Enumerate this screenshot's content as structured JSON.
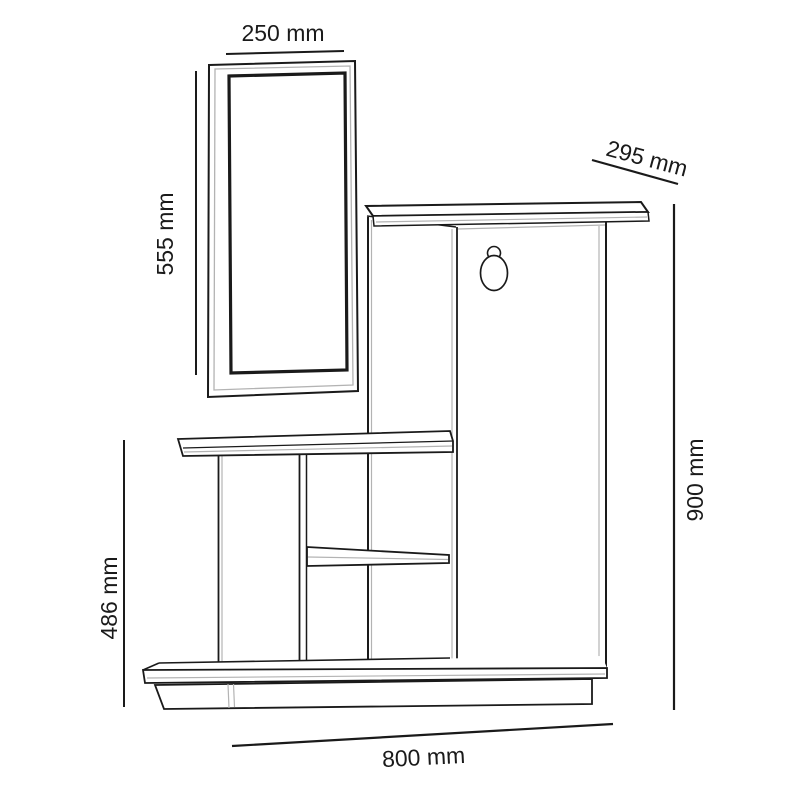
{
  "diagram": {
    "unit": "mm",
    "background": "#ffffff",
    "line_color": "#1a1a1a",
    "soft_line_color": "#b3b3b3"
  },
  "dimensions": {
    "mirror_width": "250 mm",
    "mirror_height": "555 mm",
    "top_depth": "295 mm",
    "total_height": "900 mm",
    "left_section_height": "486 mm",
    "total_width": "800 mm"
  }
}
